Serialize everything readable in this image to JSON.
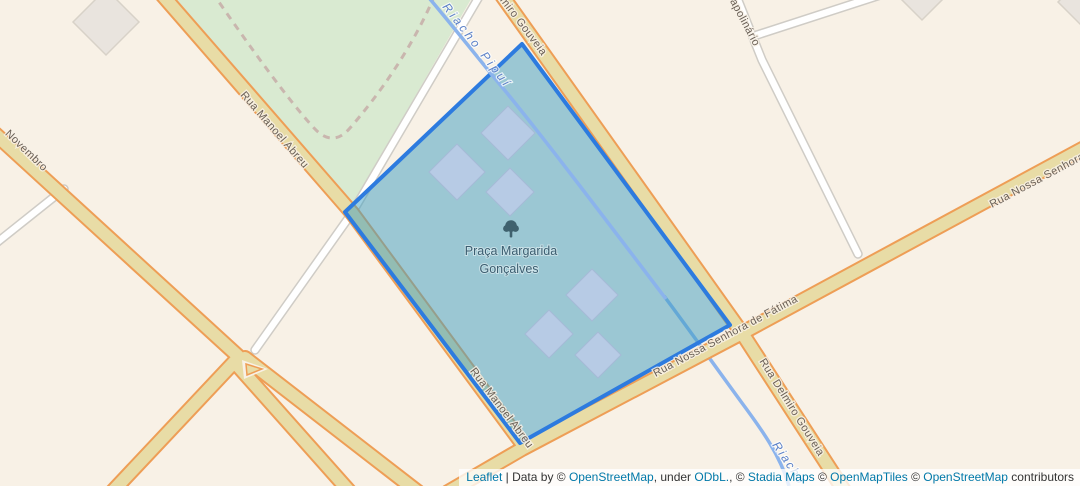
{
  "map": {
    "streets": {
      "manoel_abreu": "Rua Manoel Abreu",
      "delmiro_top": "Delmiro Gouveia",
      "delmiro": "Rua Delmiro Gouveia",
      "nossa_senhora": "Rua Nossa Senhora de Fátima",
      "nossa_senhora_ne": "Rua Nossa Senhora",
      "novembro": "Novembro",
      "apolinario": "apolinário"
    },
    "water": {
      "stream": "Riacho Pipuí",
      "stream_lower": "Riacho"
    },
    "poi": {
      "name_line1": "Praça Margarida",
      "name_line2": "Gonçalves",
      "icon": "tree-icon"
    },
    "colors": {
      "land": "#f8f1e6",
      "park": "#d9ead1",
      "road_fill": "#e8dca6",
      "road_casing": "#ee9e56",
      "minor_road_fill": "#ffffff",
      "minor_road_casing": "#cfccc6",
      "water": "#8bb3ec",
      "selection_stroke": "#2d7bdf",
      "selection_fill": "rgba(62,158,192,0.5)",
      "building": "#e9e4de",
      "building_highlight": "#b7cbe5",
      "street_label": "#6a6056",
      "water_label": "#5b80c7",
      "poi_label": "#3c5e70",
      "link": "#0078a8"
    }
  },
  "attribution": {
    "leaflet": "Leaflet",
    "sep": " | ",
    "prefix": "Data by © ",
    "osm1": "OpenStreetMap",
    "under": ", under ",
    "odbl": "ODbL.",
    "mid1": ", © ",
    "stadia": "Stadia Maps",
    "mid2": " © ",
    "omt": "OpenMapTiles",
    "mid3": " © ",
    "osm2": "OpenStreetMap",
    "suffix": " contributors"
  }
}
